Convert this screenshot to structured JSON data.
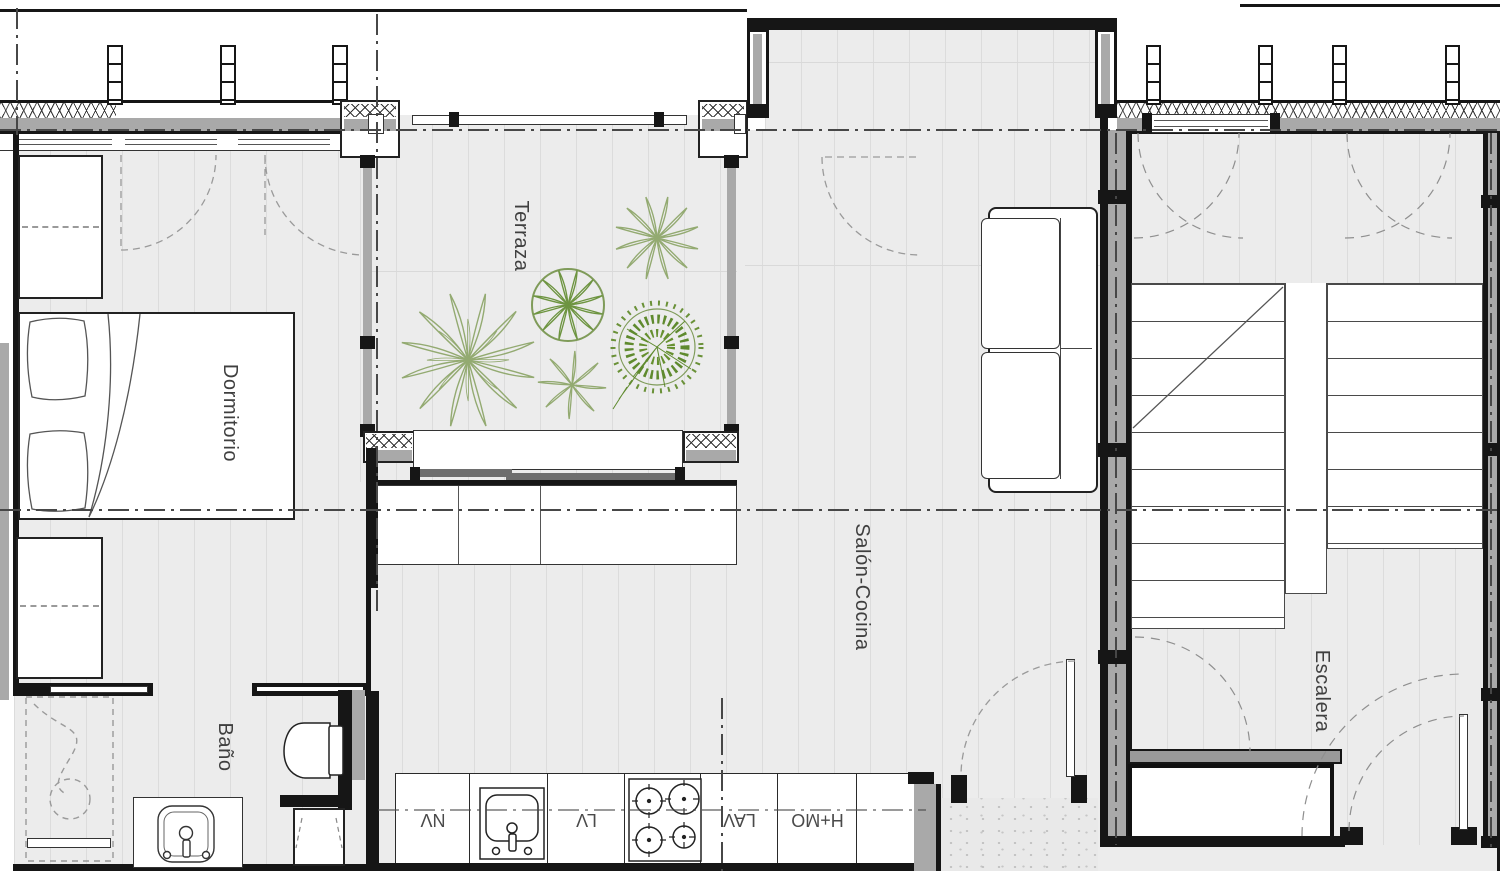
{
  "rooms": {
    "dormitorio": {
      "label": "Dormitorio"
    },
    "terraza": {
      "label": "Terraza"
    },
    "salon_cocina": {
      "label": "Salón-Cocina"
    },
    "bano": {
      "label": "Baño"
    },
    "escalera": {
      "label": "Escalera"
    }
  },
  "appliances": {
    "nv": {
      "label": "NV"
    },
    "lv": {
      "label": "LV"
    },
    "lav": {
      "label": "LAV"
    },
    "hmo": {
      "label": "H+MO"
    }
  },
  "colors": {
    "wall": "#161616",
    "floor": "#ececec",
    "floor_line": "#dcdcdc",
    "glazing_gray": "#a9a9a9",
    "plant_light": "#93aa71",
    "plant_dark": "#5f8a2e",
    "dash": "#9a9a9a",
    "label": "#3f3f3f"
  }
}
